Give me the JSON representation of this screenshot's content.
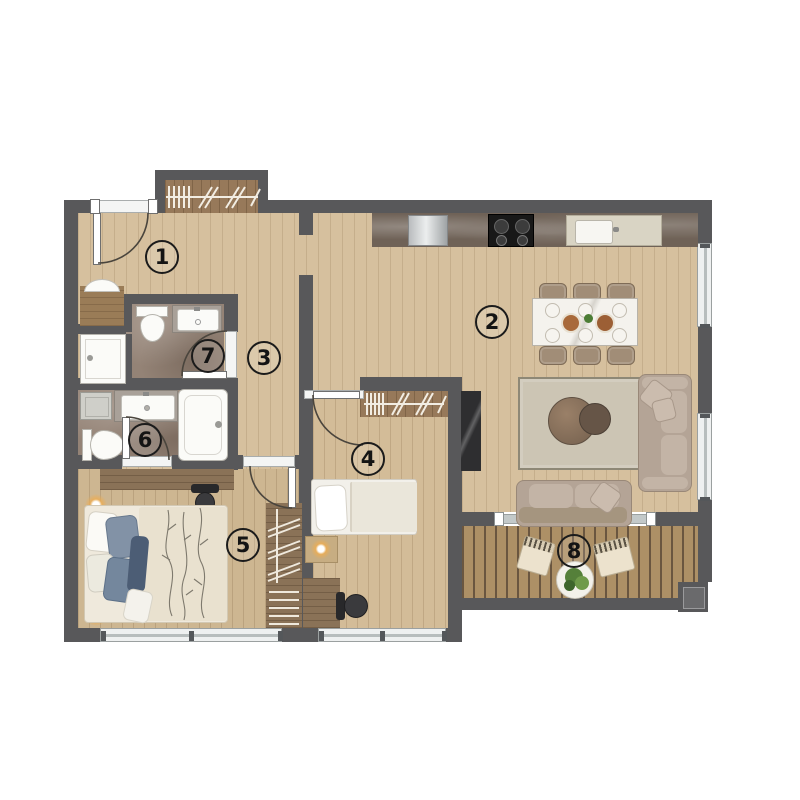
{
  "plan_title": "apartment-floor-plan",
  "rooms": {
    "r1": "1",
    "r2": "2",
    "r3": "3",
    "r4": "4",
    "r5": "5",
    "r6": "6",
    "r7": "7",
    "r8": "8"
  },
  "colors": {
    "wall": "#58585a",
    "wood_floor": "#d6c09e",
    "dark_wood": "#8f7454",
    "bath_marble": "#948376",
    "balcony_deck": "#ad9066",
    "furniture": "#b4a496",
    "label_ink": "#141414"
  }
}
